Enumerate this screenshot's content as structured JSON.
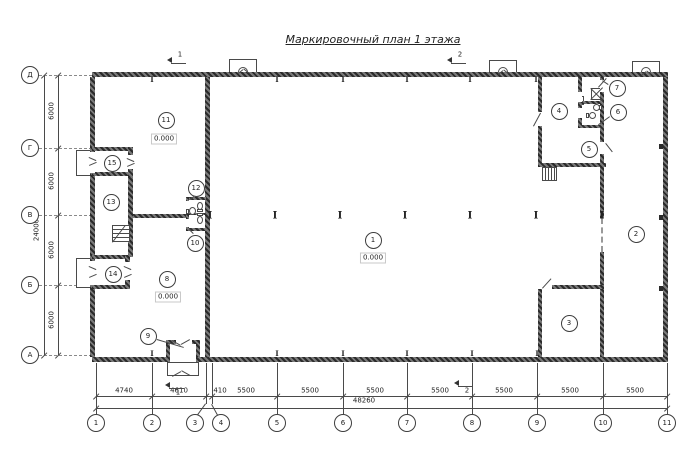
{
  "title": "Маркировочный план 1 этажа",
  "colors": {
    "line": "#4a4a4a",
    "wall": "#2b2b2b",
    "text": "#222222",
    "dash": "#8a8a8a"
  },
  "axes": {
    "left": {
      "cx": 30,
      "bubbles": [
        {
          "label": "Д",
          "y": 75
        },
        {
          "label": "Г",
          "y": 148
        },
        {
          "label": "В",
          "y": 215
        },
        {
          "label": "Б",
          "y": 285
        },
        {
          "label": "А",
          "y": 355
        }
      ]
    },
    "bottom": {
      "cy": 423,
      "bubbles": [
        {
          "label": "1",
          "x": 96,
          "ax": 96
        },
        {
          "label": "2",
          "x": 152,
          "ax": 152
        },
        {
          "label": "3",
          "x": 195,
          "ax": 206
        },
        {
          "label": "4",
          "x": 221,
          "ax": 212
        },
        {
          "label": "5",
          "x": 277,
          "ax": 277
        },
        {
          "label": "6",
          "x": 343,
          "ax": 343
        },
        {
          "label": "7",
          "x": 407,
          "ax": 407
        },
        {
          "label": "8",
          "x": 472,
          "ax": 472
        },
        {
          "label": "9",
          "x": 537,
          "ax": 537
        },
        {
          "label": "10",
          "x": 603,
          "ax": 603
        },
        {
          "label": "11",
          "x": 667,
          "ax": 667
        }
      ]
    }
  },
  "dims": {
    "bottom_row1": {
      "y": 396,
      "x1": 96,
      "x2": 667,
      "labels": [
        {
          "t": "4740",
          "x": 124
        },
        {
          "t": "4610",
          "x": 179
        },
        {
          "t": "410",
          "x": 220
        },
        {
          "t": "5500",
          "x": 246
        },
        {
          "t": "5500",
          "x": 310
        },
        {
          "t": "5500",
          "x": 375
        },
        {
          "t": "5500",
          "x": 440
        },
        {
          "t": "5500",
          "x": 504
        },
        {
          "t": "5500",
          "x": 570
        },
        {
          "t": "5500",
          "x": 635
        }
      ]
    },
    "bottom_row2": {
      "y": 408,
      "x1": 96,
      "x2": 667,
      "label": {
        "t": "48260",
        "x": 364,
        "y": 402
      }
    },
    "left_row1": {
      "x": 58,
      "y1": 75,
      "y2": 355,
      "labels": [
        {
          "t": "6000",
          "y": 111
        },
        {
          "t": "6000",
          "y": 181
        },
        {
          "t": "6000",
          "y": 250
        },
        {
          "t": "6000",
          "y": 320
        }
      ]
    },
    "left_row2": {
      "x": 44,
      "y1": 75,
      "y2": 355,
      "label": {
        "t": "24000",
        "x": 37,
        "y": 230
      }
    }
  },
  "rooms": [
    {
      "num": "1",
      "x": 373,
      "y": 240
    },
    {
      "num": "2",
      "x": 636,
      "y": 234
    },
    {
      "num": "3",
      "x": 569,
      "y": 323
    },
    {
      "num": "4",
      "x": 559,
      "y": 111
    },
    {
      "num": "5",
      "x": 589,
      "y": 149
    },
    {
      "num": "6",
      "x": 618,
      "y": 112
    },
    {
      "num": "7",
      "x": 617,
      "y": 88
    },
    {
      "num": "8",
      "x": 167,
      "y": 279
    },
    {
      "num": "9",
      "x": 148,
      "y": 336
    },
    {
      "num": "10",
      "x": 195,
      "y": 243
    },
    {
      "num": "11",
      "x": 166,
      "y": 120
    },
    {
      "num": "12",
      "x": 196,
      "y": 188
    },
    {
      "num": "13",
      "x": 111,
      "y": 202
    },
    {
      "num": "14",
      "x": 113,
      "y": 274
    },
    {
      "num": "15",
      "x": 112,
      "y": 163
    }
  ],
  "elevations": [
    {
      "t": "0.000",
      "x": 373,
      "y": 258
    },
    {
      "t": "0.000",
      "x": 164,
      "y": 139
    },
    {
      "t": "0.000",
      "x": 168,
      "y": 297
    }
  ],
  "section_marks": [
    {
      "num": "1",
      "ax": 167,
      "ay": 60,
      "lx1": 171,
      "ly1": 63,
      "lx2": 186,
      "ly2": 63,
      "tx": 180,
      "ty": 55
    },
    {
      "num": "2",
      "ax": 447,
      "ay": 60,
      "lx1": 451,
      "ly1": 63,
      "lx2": 466,
      "ly2": 63,
      "tx": 460,
      "ty": 55
    },
    {
      "num": "1",
      "ax": 165,
      "ay": 385,
      "lx1": 169,
      "ly1": 388,
      "lx2": 184,
      "ly2": 388,
      "tx": 178,
      "ty": 393
    },
    {
      "num": "2",
      "ax": 454,
      "ay": 383,
      "lx1": 458,
      "ly1": 386,
      "lx2": 473,
      "ly2": 386,
      "tx": 467,
      "ty": 391
    }
  ],
  "plan": {
    "walls": [
      [
        92,
        72,
        576,
        5
      ],
      [
        92,
        357,
        576,
        5
      ],
      [
        90,
        77,
        5,
        280
      ],
      [
        663,
        77,
        5,
        280
      ],
      [
        205,
        77,
        5,
        280
      ],
      [
        130,
        214,
        58,
        4
      ],
      [
        92,
        147,
        41,
        4
      ],
      [
        92,
        172,
        41,
        4
      ],
      [
        128,
        147,
        5,
        30
      ],
      [
        128,
        177,
        5,
        80
      ],
      [
        92,
        255,
        38,
        4
      ],
      [
        92,
        285,
        38,
        4
      ],
      [
        125,
        255,
        5,
        34
      ],
      [
        186,
        197,
        20,
        3
      ],
      [
        186,
        228,
        20,
        3
      ],
      [
        186,
        197,
        3,
        34
      ],
      [
        188,
        213,
        17,
        2
      ],
      [
        538,
        77,
        4,
        90
      ],
      [
        538,
        163,
        68,
        4
      ],
      [
        578,
        77,
        4,
        51
      ],
      [
        600,
        77,
        4,
        141
      ],
      [
        582,
        101,
        20,
        3
      ],
      [
        578,
        125,
        26,
        3
      ],
      [
        600,
        252,
        4,
        105
      ],
      [
        552,
        285,
        52,
        4
      ],
      [
        538,
        289,
        4,
        68
      ],
      [
        166,
        340,
        4,
        17
      ],
      [
        196,
        340,
        4,
        17
      ],
      [
        166,
        340,
        34,
        4
      ]
    ],
    "openings": [
      [
        90,
        152,
        5,
        21
      ],
      [
        90,
        261,
        5,
        24
      ],
      [
        128,
        155,
        5,
        14
      ],
      [
        125,
        262,
        5,
        18
      ],
      [
        170,
        357,
        26,
        5
      ],
      [
        176,
        340,
        16,
        4
      ],
      [
        538,
        112,
        4,
        14
      ],
      [
        600,
        80,
        4,
        12
      ],
      [
        600,
        142,
        4,
        12
      ],
      [
        186,
        201,
        3,
        9
      ],
      [
        186,
        219,
        3,
        8
      ],
      [
        578,
        92,
        4,
        10
      ],
      [
        578,
        108,
        4,
        10
      ]
    ],
    "thin_rects": [
      [
        76,
        150,
        16,
        26
      ],
      [
        76,
        258,
        16,
        30
      ],
      [
        167,
        362,
        32,
        14
      ],
      [
        229,
        59,
        28,
        14
      ],
      [
        489,
        60,
        28,
        14
      ],
      [
        632,
        61,
        28,
        14
      ],
      [
        591,
        88,
        12,
        12
      ],
      [
        578,
        96,
        6,
        9
      ]
    ],
    "arcs": [
      [
        238,
        67,
        10,
        6
      ],
      [
        498,
        67,
        10,
        6
      ],
      [
        641,
        67,
        10,
        6
      ]
    ],
    "stairs_h": [
      [
        112,
        225,
        18,
        17
      ]
    ],
    "stairs_v": [
      [
        542,
        167,
        15,
        14
      ]
    ],
    "dash_partition": [
      601,
      218,
      34
    ],
    "lines": [
      [
        533,
        126,
        540,
        113
      ],
      [
        598,
        87,
        606,
        78
      ],
      [
        606,
        143,
        613,
        152
      ],
      [
        542,
        288,
        551,
        278
      ],
      [
        591,
        88,
        603,
        100
      ],
      [
        603,
        88,
        591,
        100
      ],
      [
        157,
        339,
        184,
        347
      ],
      [
        608,
        85,
        602,
        81
      ],
      [
        610,
        117,
        599,
        125
      ],
      [
        194,
        197,
        190,
        200
      ],
      [
        193,
        234,
        189,
        230
      ],
      [
        89,
        157,
        96,
        160
      ],
      [
        89,
        165,
        96,
        162
      ],
      [
        127,
        158,
        134,
        161
      ],
      [
        127,
        166,
        134,
        163
      ],
      [
        89,
        266,
        96,
        269
      ],
      [
        89,
        277,
        96,
        274
      ],
      [
        124,
        266,
        131,
        269
      ],
      [
        124,
        277,
        131,
        274
      ],
      [
        172,
        340,
        181,
        345
      ],
      [
        190,
        340,
        181,
        345
      ],
      [
        172,
        376,
        181,
        371
      ],
      [
        190,
        376,
        181,
        371
      ],
      [
        238,
        73,
        243,
        69
      ],
      [
        248,
        73,
        243,
        69
      ],
      [
        498,
        74,
        503,
        70
      ],
      [
        508,
        74,
        503,
        70
      ],
      [
        641,
        75,
        646,
        71
      ],
      [
        651,
        75,
        646,
        71
      ],
      [
        112,
        242,
        125,
        225
      ],
      [
        206,
        404,
        198,
        415
      ],
      [
        212,
        404,
        218,
        415
      ]
    ],
    "columns_hall": {
      "y": 217,
      "x": [
        210,
        275,
        340,
        405,
        470,
        536,
        602
      ]
    },
    "columns_top": {
      "y": 80,
      "x": [
        152,
        277,
        343,
        407,
        470,
        536
      ]
    },
    "columns_bottom": {
      "y": 354,
      "x": [
        152,
        277,
        343,
        407,
        472,
        537
      ]
    },
    "wall_ticks_right": [
      [
        659,
        144
      ],
      [
        659,
        215
      ],
      [
        659,
        286
      ]
    ],
    "fixtures": [
      {
        "bowl": [
          189,
          207,
          7,
          8
        ],
        "tank": [
          186,
          209,
          3,
          5
        ]
      },
      {
        "bowl": [
          197,
          202,
          6,
          8
        ],
        "tank": [
          197,
          209,
          6,
          3
        ]
      },
      {
        "bowl": [
          197,
          216,
          6,
          8
        ],
        "tank": [
          197,
          213,
          6,
          3
        ]
      },
      {
        "bowl": [
          593,
          104,
          7,
          7
        ],
        "tank": [
          599,
          105,
          3,
          5
        ]
      },
      {
        "bowl": [
          589,
          112,
          7,
          7
        ],
        "tank": [
          586,
          113,
          3,
          5
        ]
      }
    ]
  }
}
